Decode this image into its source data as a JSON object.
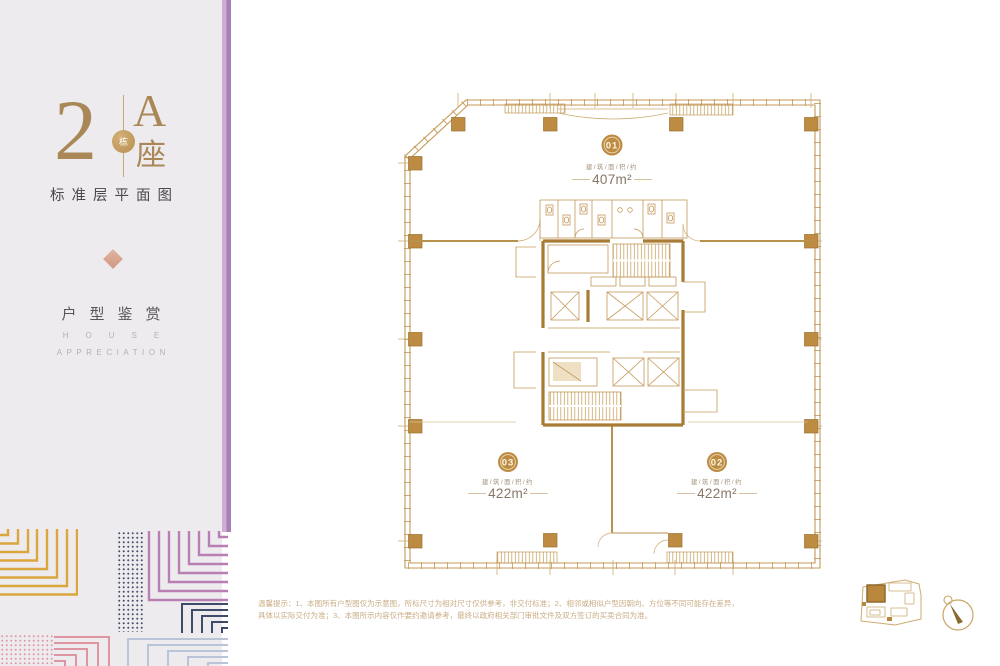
{
  "sidebar": {
    "big_number": "2",
    "circle_char": "栋",
    "tower_letter": "A",
    "tower_suffix": "座",
    "plan_subtitle": "标准层平面图",
    "section_cn": "户型鉴赏",
    "section_en1": "HOUSE",
    "section_en2": "APPRECIATION"
  },
  "plan": {
    "area_prefix": "建/筑/面/积/约",
    "units": [
      {
        "no": "01",
        "area": "407m²"
      },
      {
        "no": "02",
        "area": "422m²"
      },
      {
        "no": "03",
        "area": "422m²"
      }
    ]
  },
  "footer": {
    "line1": "温馨提示：1、本图所有户型图仅为示意图，所标尺寸为相对尺寸仅供参考，非交付标准；2、相邻或相似户型因朝向、方位等不同可能存在差异，",
    "line2": "具体以实际交付为准；3、本图所示内容仅作要约邀请参考，最终以政府相关部门审批文件及双方签订的买卖合同为准。"
  },
  "colors": {
    "plan_gold": "#c49a5a",
    "deep_gold": "#a87c35",
    "column_fill": "#bd8c42",
    "badge_fill": "#bd8c42",
    "area_text": "#877767",
    "title_bronze": "#a98756",
    "purple_stripe": "#a97fb7",
    "pattern_gold": "#dca63e",
    "pattern_mauve": "#b97fb3",
    "pattern_navy": "#3f4c69",
    "pattern_pink": "#de95a2",
    "pattern_blue": "#b9c4d9",
    "sidebar_bg": "#edebee",
    "disclaimer_text": "#c9ad85"
  }
}
